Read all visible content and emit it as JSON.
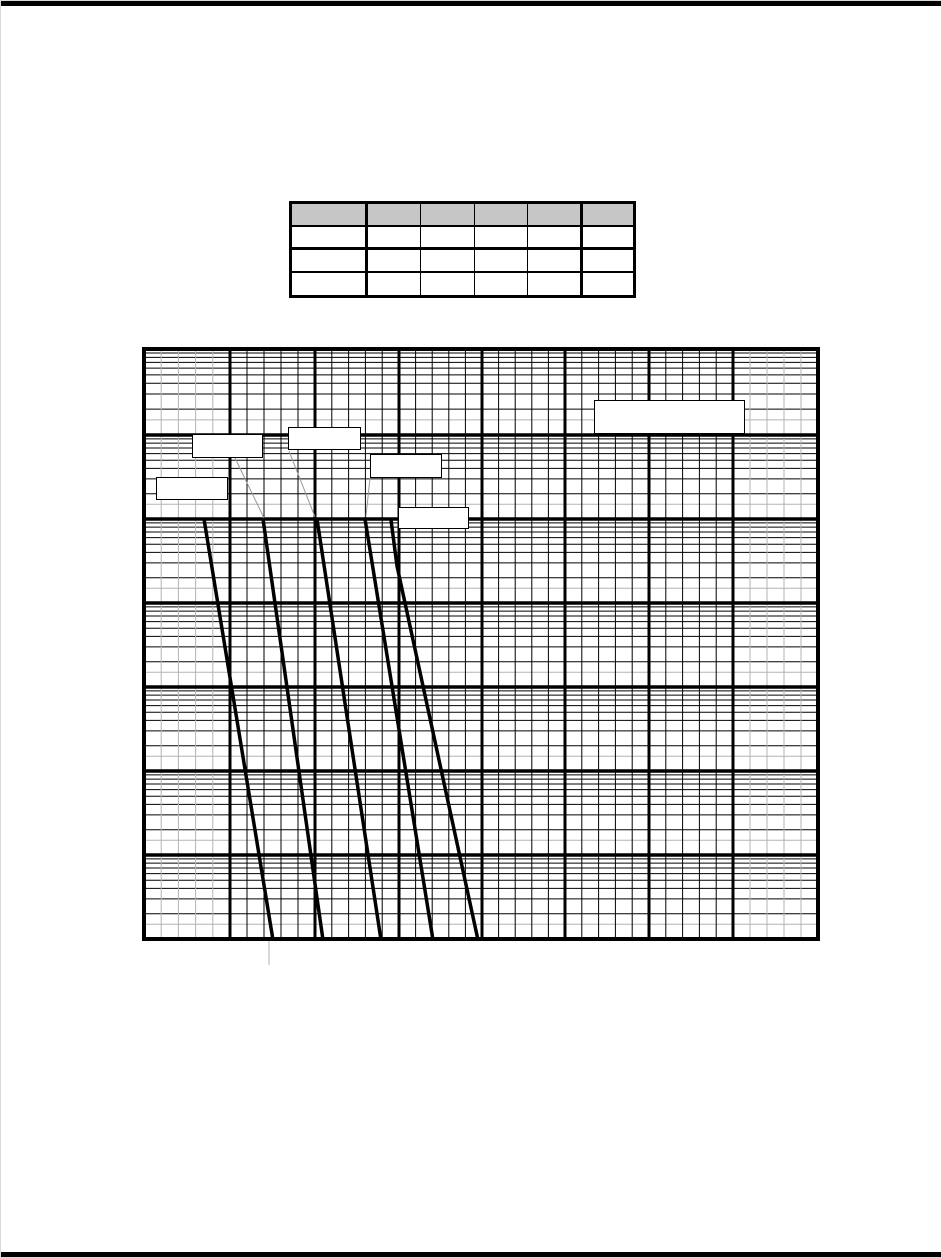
{
  "page": {
    "background": "#ffffff",
    "top_rule_color": "#000000",
    "bottom_rule_color": "#000000"
  },
  "table": {
    "header_fill": "#c6c6c6",
    "border_color": "#000000",
    "header_cells": [
      "",
      "",
      "",
      "",
      "",
      ""
    ],
    "body_rows": [
      [
        "",
        "",
        "",
        "",
        "",
        ""
      ],
      [
        "",
        "",
        "",
        "",
        "",
        ""
      ],
      [
        "",
        "",
        "",
        "",
        "",
        ""
      ]
    ]
  },
  "chart_data": {
    "type": "line",
    "title": "",
    "xlabel": "",
    "ylabel": "",
    "axes_labeled": false,
    "grid": "log-style",
    "colors": {
      "major_line": "#000000",
      "minor_line": "#000000",
      "faint_line": "#b3b3b3",
      "curve": "#000000",
      "leader": "#999999",
      "tick_below_axis": "#cccccc",
      "box_fill": "#ffffff",
      "box_border": "#000000"
    },
    "x_majors": [
      0,
      86,
      171,
      255,
      338,
      421,
      505,
      589,
      674
    ],
    "y_majors": [
      0,
      86,
      170,
      254,
      338,
      422,
      506,
      590
    ],
    "x_minor_fracs": [
      0.2,
      0.4,
      0.6,
      0.8
    ],
    "gray_minor_columns": [
      0,
      7
    ],
    "y_minor_fracs_black": [
      0.046,
      0.097,
      0.155,
      0.222,
      0.301,
      0.398,
      0.523,
      0.699
    ],
    "y_minor_fracs_gray": [
      0.824
    ],
    "curves": [
      {
        "name": "curve-1",
        "points": [
          [
            60,
            170
          ],
          [
            129,
            591
          ]
        ]
      },
      {
        "name": "curve-2",
        "points": [
          [
            119,
            170
          ],
          [
            179,
            591
          ]
        ]
      },
      {
        "name": "curve-3",
        "points": [
          [
            173,
            170
          ],
          [
            237,
            591
          ]
        ]
      },
      {
        "name": "curve-4",
        "points": [
          [
            221,
            170
          ],
          [
            289,
            591
          ]
        ]
      },
      {
        "name": "curve-5",
        "points": [
          [
            247,
            171
          ],
          [
            253,
            217
          ],
          [
            334,
            591
          ]
        ]
      }
    ],
    "leader_lines": [
      {
        "from": [
          91,
          109
        ],
        "to": [
          120,
          169
        ]
      },
      {
        "from": [
          145,
          102
        ],
        "to": [
          171,
          168
        ]
      },
      {
        "from": [
          226,
          129
        ],
        "to": [
          222,
          167
        ]
      }
    ],
    "below_axis_tick": {
      "x": 125,
      "y1": 592,
      "y2": 616
    },
    "label_boxes": [
      {
        "name": "curve1-label-box",
        "x": 12,
        "y": 128,
        "w": 72,
        "h": 23,
        "label": ""
      },
      {
        "name": "curve2-label-box",
        "x": 48,
        "y": 85,
        "w": 71,
        "h": 24,
        "label": ""
      },
      {
        "name": "curve3-label-box",
        "x": 144,
        "y": 78,
        "w": 73,
        "h": 23,
        "label": ""
      },
      {
        "name": "curve4-label-box",
        "x": 226,
        "y": 105,
        "w": 72,
        "h": 24,
        "label": ""
      },
      {
        "name": "curve5-label-box",
        "x": 254,
        "y": 158,
        "w": 71,
        "h": 22,
        "label": ""
      },
      {
        "name": "chart-title-box",
        "x": 450,
        "y": 51,
        "w": 151,
        "h": 34,
        "label": ""
      }
    ]
  }
}
